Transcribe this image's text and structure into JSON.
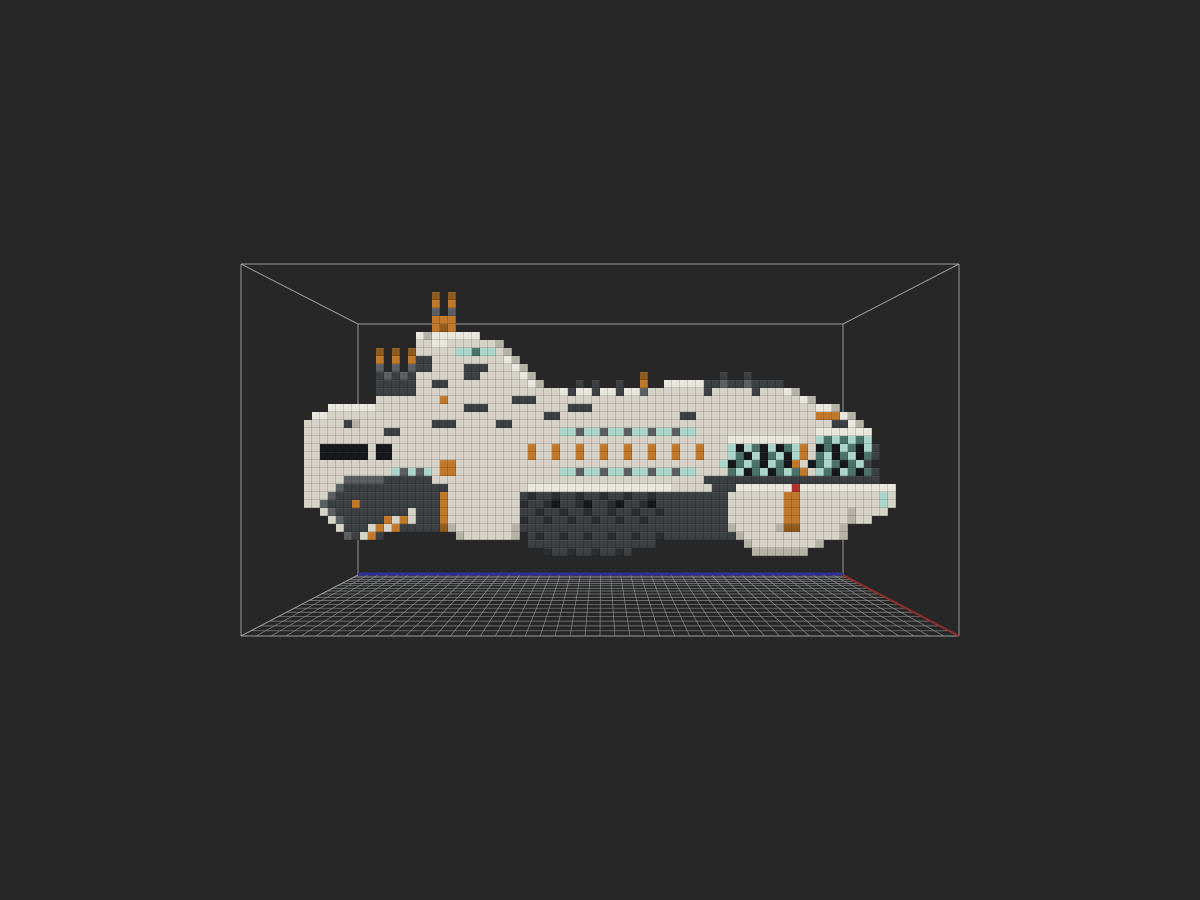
{
  "viewport": {
    "width": 1200,
    "height": 900,
    "background_color": "#272727"
  },
  "bounding_box": {
    "stroke_color": "#adadad",
    "stroke_width": 1,
    "opacity": 0.85,
    "front_rect": {
      "left": 241,
      "top": 264,
      "right": 959,
      "bottom": 636
    },
    "back_rect": {
      "left": 358,
      "top": 324,
      "right": 843,
      "bottom": 575
    }
  },
  "floor_grid": {
    "line_color": "#9a9c9e",
    "line_width": 0.7,
    "line_opacity": 0.8,
    "columns": 48,
    "rows": 19,
    "back_edge_axis": {
      "color": "#31309b",
      "width": 3
    },
    "right_edge_axis": {
      "color": "#8e2f28",
      "width": 2
    }
  },
  "voxel_model": {
    "name": "voxel-spaceship",
    "origin_x": 304,
    "origin_y": 292,
    "cell_size": 8,
    "palette": {
      "w": "#e9e6dd",
      "W": "#d6d2c8",
      "d": "#b5b1a7",
      "g": "#5b5f62",
      "G": "#3c3f42",
      "D": "#2b2d30",
      "K": "#17181a",
      "O": "#c2782a",
      "o": "#8f5a1e",
      "T": "#a9d6c8",
      "t": "#4a7268",
      "R": "#b03228"
    },
    "rows": [
      "................o.o",
      "................O.O",
      "................g.g",
      "................OOO",
      "................OoO",
      "..............wdwwwwww",
      "..............WWwwWWWWWWd",
      ".........o.o.oWWWWWTTtTTWd",
      ".........O.O.OGGWWWWWWWWWwd",
      ".........g.g.gGGWWWWGGGWWWwd",
      ".........GgGgGWWWWWWGGWWWWWwd.............o.........G..G",
      ".........GGGGGWWGGWWWWWWWWWWwd....G.G..G..O..wwwwwGGgGGgGGGG",
      ".........GGGGGWWWWWWWWWWWWWWWWWWwGwwGwwGwwgWWWWWWWGWWWWWGWWWwd",
      ".........WWWWWWWWOWWWWWWWWGGGWWWWWWWWWWWWWWWWWWWWWWWWWWWWWWWWWwd",
      "...wwwwwwWWWWWWWWWWWGGGWWWWWWWWWWGGGWWWWWWWWWWWWWWWWWWWWWWWWWWWWwwd",
      ".wwWWWWWWWWWWWWWWWWWWWWWWWWWWWGGWWWWWWWWWWWWWWWGGWWWWWWWWWWWWWWWOOOwd",
      "WWWWWGdWWWWWWWWWGGGWWWWWGGWWWWWWWWWWWWWWWWWWWWWWWWWWWWWWWWWWWWWWWWGGwd",
      "WWWWWWWWWWGGWWWWWWWWWWWWWWWWWWWWTTgTTgTTgTTgTTgTTWWWWWWWWWWWWWWWwwwwwww",
      "WWWWWWWWWWWWWWWWWWWWWWWWWWWWWWWWWWWWWWWWWWWWWWWWWWWWWwwwwwwwwwWWTtTtTtT",
      "WWKKKKKKWKKWWWWWWWWWWWWWWWWWOWWOWWOWWOWWOWWOWWOWWOWWWTKTtKTKtTOWKtKTtKTG",
      "WWKKKKKKWKKWWWWWWWWWWWWWWWWWOWWOWWOWWOWWOWWOWWOWWOWWWTtKTKtTKTOWtTKtTKtG",
      "WWWWWWWWWWWWWWWWWOOWWWWWWWWWWWWWWWWWWWWWWWWWWWWWWWWWTKtTtKTtKOWKtTtKtTG",
      "WWWWWWWWWWWTgTgTWOOWWWWWWWWWWWWWTTgTTgTTgTTgTTgTTWWWWtTKtTKtTtOWTtKTtKtG",
      "WWWWWgggggGGGGGGWWWWWWWWWWWWWWWWWWWWWWWWWWWWWWWWWWGGGGGGGGGGGGGGGGGGGGGG",
      "WWWWgGGGGGGGGGGGGGWWWWWWWWWWwwwwwwwwwwwwwwwwwwWWWWWGGGwwwwwwwRwwwwwwwwwwwww",
      "WWWgGGGGGGGGGGGGGOWWWWWWWWWGDGGDGGDGGDGGDGGDGGGGGGGGGWWWWWWWOOWWWWWWWWWWTW",
      "WWgGGGOGGGGGGGGGGOWWWWWWWWWDGGDKGGDKGGDKGGDKGGGGGGGGGWWWWWWWOOWWWWWWWWWWTW",
      "..WgGGGGGGGGGWGGGOWWWWWWWWWGGDGGDGGDGGDGGDGGDGGGGGGGGWWWWWWWOOWWWWWWdWWWW",
      "...WgGGGGGOWOWGGGOWWWWWWWWWDGGDGGDGGDGGDGGDGGGGGGGGGGWWWWWWWOOWWWWWWdWW",
      "....WGGGWOWOGGGGGodWWWWWWWdGGGGGGGGGGGGGGGGGGGGGGGGGGdWWWWWdooWWWWWd",
      ".....gGWOG.........dWWWWWWd.GDGGDGGDGGDGGDGGDGGGGGGGGGdWWWWWWWWWWWWd",
      "............................GGGGGGGGGGGGGGGG...........dWWWWWWWWd",
      "..............................DGGDGGDGGDG...............ddddddd"
    ]
  }
}
